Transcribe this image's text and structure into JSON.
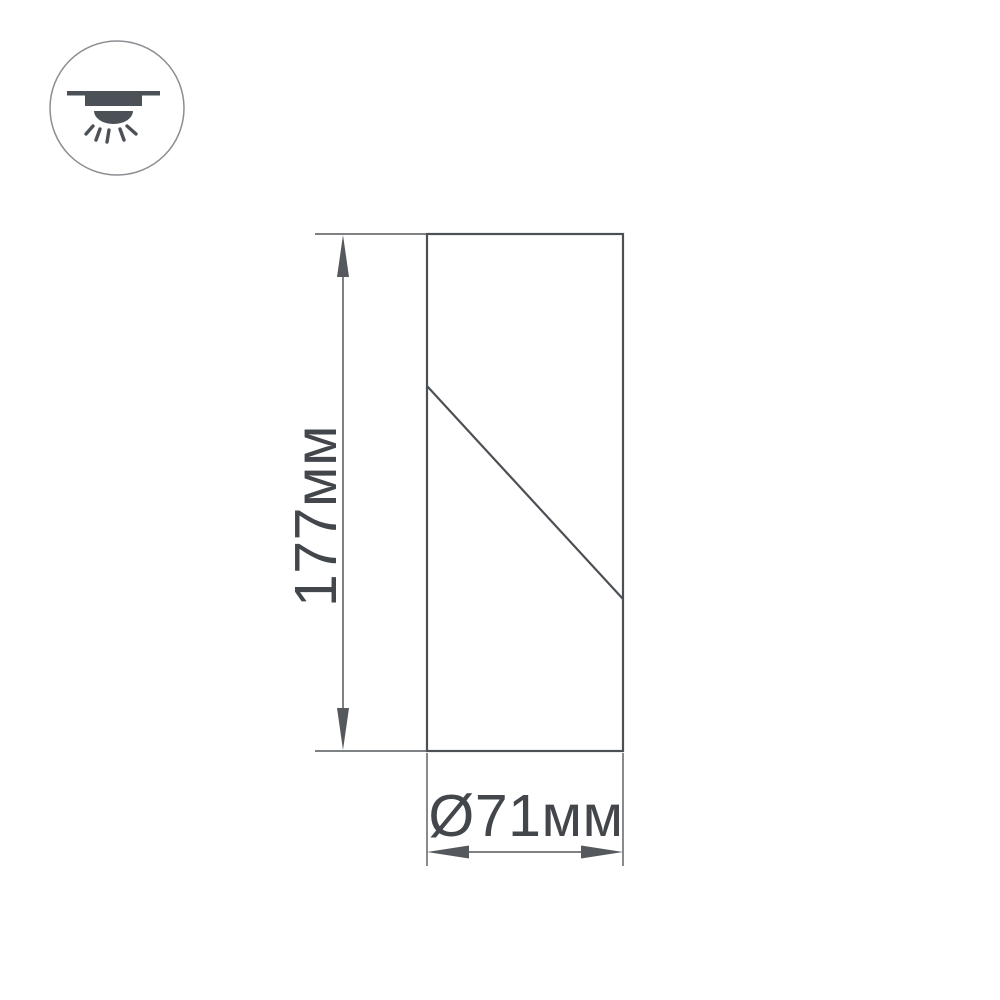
{
  "page": {
    "type": "technical-dimension-drawing",
    "subject": "cylindrical surface-mounted ceiling spot luminaire"
  },
  "icons": {
    "badge": "ceiling-light-icon"
  },
  "dimensions": {
    "height": {
      "label": "177мм",
      "value": 177,
      "unit": "мм"
    },
    "diameter": {
      "label": "Ø71мм",
      "value": 71,
      "unit": "мм",
      "symbol": "Ø"
    }
  },
  "colors": {
    "background": "#ffffff",
    "line": "#4c5055",
    "dim_line": "#55585c",
    "text": "#43474b",
    "icon_glyph": "#4b5156",
    "icon_circle": "#8a8e92"
  }
}
